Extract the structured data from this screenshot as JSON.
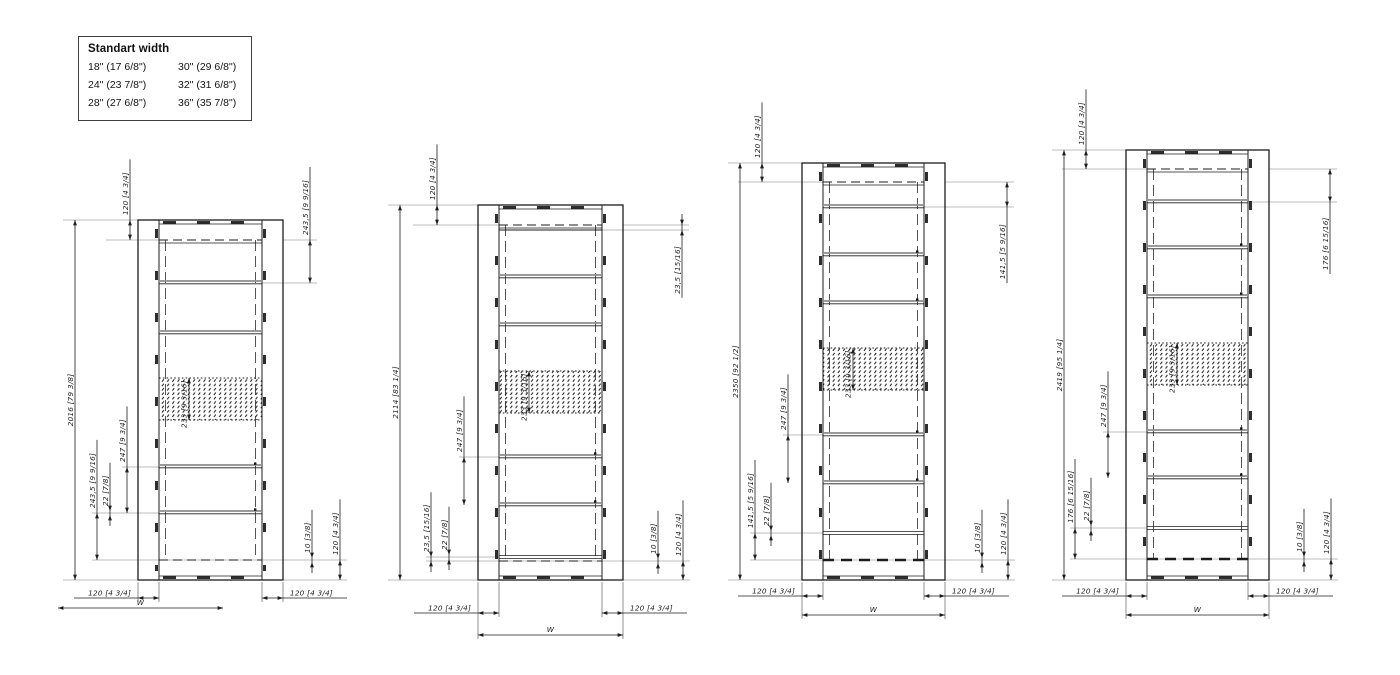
{
  "standard_width_table": {
    "title": "Standart width",
    "rows": [
      [
        "18\" (17 6/8\")",
        "30\" (29 6/8\")"
      ],
      [
        "24\" (23 7/8\")",
        "32\" (31 6/8\")"
      ],
      [
        "28\" (27 6/8\")",
        "36\" (35 7/8\")"
      ]
    ]
  },
  "drawings": [
    {
      "name": "frame-variant-1",
      "labels": {
        "total_height": "2016 [79 3/8]",
        "top_offset": "120 [4 3/4]",
        "upper_spacing": "243,5 [9 9/16]",
        "lower_spacing": "243,5 [9 9/16]",
        "rung_thickness": "22 [7/8]",
        "rung_spacing": "247 [9 3/4]",
        "hatch_height": "233 [9 3/16]",
        "bottom_gap": "10 [3/8]",
        "bottom_offset": "120 [4 3/4]",
        "foot_left": "120 [4 3/4]",
        "foot_right": "120 [4 3/4]",
        "width": "W"
      },
      "geometry": {
        "frame_left": 138,
        "frame_top": 220,
        "frame_width": 145,
        "frame_bottom": 580,
        "dashed_top": 240,
        "rung0": null,
        "rungs": [
          283,
          333,
          467,
          513
        ],
        "dots": [
          2,
          3
        ],
        "hatch": [
          378,
          420
        ],
        "thin": null,
        "dashed_bottom": 560,
        "thick_dash": false,
        "dim_total_x": 75,
        "dim_top_x": 130,
        "dim_upper_x": 310,
        "upper_pos": "above",
        "dim_lower_xs": [
          97,
          110,
          127
        ],
        "dim_right_xs": [
          312,
          340
        ],
        "foot_y": 598,
        "w_y": 608,
        "w_span": [
          58,
          223
        ],
        "w_ext": false
      }
    },
    {
      "name": "frame-variant-2",
      "labels": {
        "total_height": "2114 [83 1/4]",
        "top_offset": "120 [4 3/4]",
        "upper_spacing": "23,5 [15/16]",
        "lower_spacing": "23,5 [15/16]",
        "rung_thickness": "22 [7/8]",
        "rung_spacing": "247 [9 3/4]",
        "hatch_height": "233 [9 3/16]",
        "bottom_gap": "10 [3/8]",
        "bottom_offset": "120 [4 3/4]",
        "foot_left": "120 [4 3/4]",
        "foot_right": "120 [4 3/4]",
        "width": "W"
      },
      "geometry": {
        "frame_left": 478,
        "frame_top": 205,
        "frame_width": 145,
        "frame_bottom": 580,
        "dashed_top": 225,
        "rung0": 230,
        "rungs": [
          277,
          325,
          457,
          505
        ],
        "dots": [
          2,
          3
        ],
        "hatch": [
          371,
          413
        ],
        "thin": 557,
        "dashed_bottom": 561,
        "thick_dash": false,
        "dim_total_x": 400,
        "dim_top_x": 437,
        "dim_upper_x": 682,
        "upper_pos": "below",
        "dim_lower_xs": [
          431,
          449,
          464
        ],
        "dim_right_xs": [
          658,
          683
        ],
        "foot_y": 613,
        "w_y": 635,
        "w_span": [
          478,
          623
        ],
        "w_ext": true
      }
    },
    {
      "name": "frame-variant-3",
      "labels": {
        "total_height": "2350 [92 1/2]",
        "top_offset": "120 [4 3/4]",
        "upper_spacing": "141,5 [5 9/16]",
        "lower_spacing": "141,5 [5 9/16]",
        "rung_thickness": "22 [7/8]",
        "rung_spacing": "247 [9 3/4]",
        "hatch_height": "233 [9 3/16]",
        "bottom_gap": "10 [3/8]",
        "bottom_offset": "120 [4 3/4]",
        "foot_left": "120 [4 3/4]",
        "foot_right": "120 [4 3/4]",
        "width": "W"
      },
      "geometry": {
        "frame_left": 802,
        "frame_top": 163,
        "frame_width": 143,
        "frame_bottom": 580,
        "dashed_top": 182,
        "rung0": null,
        "rungs": [
          207,
          255,
          303,
          435,
          483
        ],
        "dots": [
          1,
          2,
          3,
          4
        ],
        "hatch": [
          348,
          390
        ],
        "thin": 533,
        "dashed_bottom": 560,
        "thick_dash": true,
        "dim_total_x": 740,
        "dim_top_x": 762,
        "dim_upper_x": 1007,
        "upper_pos": "below",
        "dim_lower_xs": [
          755,
          771,
          788
        ],
        "dim_right_xs": [
          982,
          1008
        ],
        "foot_y": 596,
        "w_y": 615,
        "w_span": [
          802,
          945
        ],
        "w_ext": true
      }
    },
    {
      "name": "frame-variant-4",
      "labels": {
        "total_height": "2419 [95 1/4]",
        "top_offset": "120 [4 3/4]",
        "upper_spacing": "176 [6 15/16]",
        "lower_spacing": "176 [6 15/16]",
        "rung_thickness": "22 [7/8]",
        "rung_spacing": "247 [9 3/4]",
        "hatch_height": "233 [9 3/16]",
        "bottom_gap": "10 [3/8]",
        "bottom_offset": "120 [4 3/4]",
        "foot_left": "120 [4 3/4]",
        "foot_right": "120 [4 3/4]",
        "width": "W"
      },
      "geometry": {
        "frame_left": 1126,
        "frame_top": 150,
        "frame_width": 143,
        "frame_bottom": 580,
        "dashed_top": 169,
        "rung0": null,
        "rungs": [
          202,
          248,
          297,
          432,
          478
        ],
        "dots": [
          1,
          2,
          3,
          4
        ],
        "hatch": [
          343,
          385
        ],
        "thin": 528,
        "dashed_bottom": 559,
        "thick_dash": true,
        "dim_total_x": 1064,
        "dim_top_x": 1086,
        "dim_upper_x": 1330,
        "upper_pos": "below",
        "dim_lower_xs": [
          1075,
          1091,
          1108
        ],
        "dim_right_xs": [
          1304,
          1331
        ],
        "foot_y": 596,
        "w_y": 615,
        "w_span": [
          1126,
          1269
        ],
        "w_ext": true
      }
    }
  ]
}
